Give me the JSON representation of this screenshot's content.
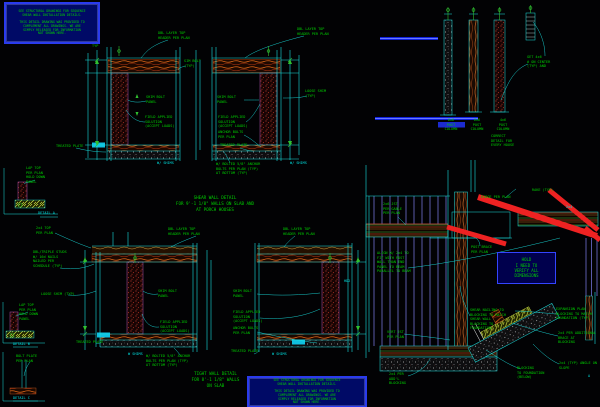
{
  "colors": {
    "background": "#020204",
    "line_cyan": "#19e0e0",
    "text_green": "#00d000",
    "text_cyan": "#00e0e0",
    "hatch_red": "#d04030",
    "wood_orange": "#e06818",
    "stud_purple": "#8080f0",
    "brace_red": "#ee2222",
    "highlight_blue": "#2233ee",
    "note_box_bg": "#000a66",
    "note_box_border": "#2a3bee"
  },
  "notes": {
    "structural_top": "SEE STRUCTURAL DRAWINGS FOR SEQUENCE\nSHEAR WALL INSTALLATION DETAILS.\n\nTHIS DETAIL DRAWING WAS PROVIDED TO\nCOMPLEMENT ALL DRAWINGS. WE ARE\nSIMPLY RELEASED FOR INFORMATION\nNOT SHOWN HERE.",
    "structural_bottom": "SEE STRUCTURAL DRAWINGS FOR SEQUENCE\nSHEAR WALL INSTALLATION DETAILS.\n\nTHIS DETAIL DRAWING WAS PROVIDED TO\nCOMPLEMENT ALL DRAWINGS. WE ARE\nSIMPLY RELEASED FOR INFORMATION\nNOT SHOWN HERE.",
    "hold": "HOLD\nI NEED TO\nVERIFY ALL\nDIMENSIONS"
  },
  "titles": {
    "shear_wall": "SHEAR WALL DETAIL\nFOR 9'-1 1/8\" WALLS ON SLAB AND\nAT PORCH HOUSES",
    "tight_wall": "TIGHT WALL DETAIL\nFOR 8'-1 1/8\" WALLS\nON SLAB"
  },
  "labels": {
    "tl": {
      "typ": "TYP",
      "header1": "DBL LAYER TOP\nHEADER PER PLAN",
      "header2": "DBL LAYER TOP\nHEADER PER PLAN",
      "simbolt_top": "SIM BOLT\n(TYP)",
      "shim1": "SHIM BOLT\nPANEL",
      "field1": "FIELD APPLIED\nSOLUTION\n(ACCEPT LOADS)",
      "treated1": "TREATED PLATE",
      "shim2": "SHIM BOLT\nPANEL",
      "field2": "FIELD APPLIED\nSOLUTION\n(ACCEPT LOADS)",
      "anchor2": "ANCHOR BOLTS\nPER PLAN",
      "treated2": "TREATED PLATE",
      "loose": "LOOSE SHIM\n(TYP)",
      "wshims1": "W/ SHIMS",
      "wshims2": "W/ SHIMS",
      "sill_note": "W/ BOLTED 5/8\" ANCHOR\nBOLTS PER PLAN (TYP)\nAT BOTTOM (TYP)"
    },
    "bl": {
      "top1": "2x4 TOP\nPER PLAN",
      "top2": "DBL LAYER TOP\nHEADER PER PLAN",
      "top3": "DBL LAYER TOP\nHEADER PER PLAN",
      "studs_note": "DBL/TRIPLE STUDS\nW/ 16d NAILS\nNAILED PER\nSCHEDULE (TYP)",
      "loose": "LOOSE SHIM (TYP)",
      "shim3": "SHIM BOLT\nPANEL",
      "field3": "FIELD APPLIED\nSOLUTION\n(ACCEPT LOADS)",
      "treated3": "TREATED PLATE",
      "wshims3": "W SHIMS",
      "sill_note": "W/ BOLTED 5/8\" ANCHOR\nBOLTS PER PLAN (TYP)\nAT BOTTOM (TYP)",
      "shim4": "SHIM BOLT\nPANEL",
      "field4": "FIELD APPLIED\nSOLUTION\n(ACCEPT LOADS)",
      "anchor4": "ANCHOR BOLTS\nPER PLAN",
      "treated4": "TREATED PLATE",
      "wshims4": "W SHIMS",
      "hd2": "HD2"
    },
    "details": {
      "a_note": "LAP TOP\nPER PLAN\nHOLD DOWN\nPANEL",
      "a_label": "DETAIL A",
      "b_note": "LAP TOP\nPER PLAN\nHOLD DOWN\nPANEL",
      "b_label": "DETAIL B",
      "c_note": "BOLT PLATE\nPER PLAN",
      "c_label": "DETAIL C"
    },
    "tr": {
      "col1": "6x6\nPOST\nCOLUMN",
      "col2": "6x6\nPOST\nCOLUMN",
      "col3": "4x6\nPOST\nCOLUMN",
      "col3b": "CORRECT\nDETAIL FOR\nEVERY HOUSE",
      "note": "GET 4x6\n# ON CENTER\n(TYP) AND"
    },
    "br": {
      "jst": "2x6 JST\nPER GABLE\nPER PLAN",
      "ridge": "RIDGE PER PLAN",
      "rake": "RAKE (TYP)",
      "c24": "2x4",
      "post_brace": "POST BRACE\nPER PLAN",
      "align_note": "ALIGN W/ 2x4 TO\nFIT WITH POST\nWALL THAN END\nPANEL TO BEAM\nPARALLEL TO BEAM",
      "shear_note": "SHEAR NAILING TO\nBLOCKING TO MATCH\nSHEAR WALL\nBLOCKING TO\nFOUNDATION",
      "vert": "VERT JST\nPER PLAN",
      "addtl": "2x4 PER\nADD'L\nBLOCKING",
      "iso1": "EXPANSION PLAN\nBLOCKING TO MATCH\nFOUNDATION (TYP)",
      "iso2": "2x4 PER ADDITIONAL\nBRACE AT\nBLOCKING",
      "iso3": "2x4 (TYP) ANGLE ON\nSLOPE",
      "iso4": "BLOCKING\nTO FOUNDATION\n(BELOW)",
      "mini_a": "A"
    }
  }
}
